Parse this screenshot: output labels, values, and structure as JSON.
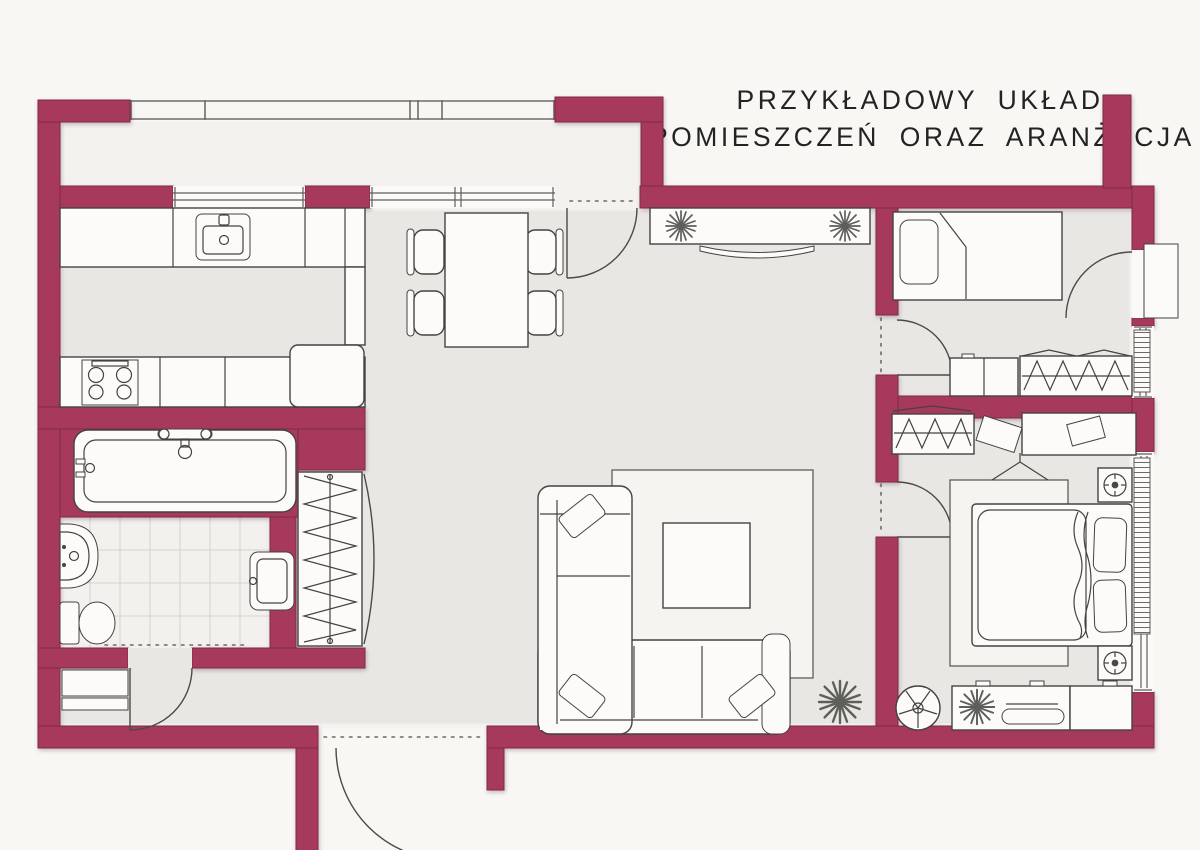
{
  "title": {
    "line_1": "PRZYKŁADOWY UKŁAD",
    "line_2": "POMIESZCZEŃ ORAZ ARANŻACJA"
  },
  "palette": {
    "wall": "#a73a5c",
    "wall_edge": "#7d2a49",
    "floor": "#e9e7e4",
    "tile": "#f2f1ee",
    "outside": "#f8f7f4",
    "furn_fill": "#fcfbf9",
    "furn_stroke": "#45433f",
    "rug": "#f5f4f1",
    "plant": "#5e5e5a",
    "text": "#232323",
    "railing": "#6f6d69"
  },
  "floorplan": {
    "rooms": [
      {
        "name": "balcony",
        "furniture": [
          "railing",
          "partition-wall",
          "pier"
        ]
      },
      {
        "name": "kitchen",
        "furniture": [
          "counter-top",
          "sink",
          "tall-cabinet",
          "counter-bottom",
          "hob",
          "fridge",
          "window"
        ]
      },
      {
        "name": "dining-area",
        "furniture": [
          "table",
          "chair",
          "chair",
          "chair",
          "chair",
          "window",
          "balcony-door"
        ]
      },
      {
        "name": "living-room",
        "furniture": [
          "sideboard",
          "plant",
          "plant",
          "tv-console",
          "rug",
          "coffee-table",
          "corner-sofa",
          "cushions",
          "floor-plant"
        ]
      },
      {
        "name": "hall",
        "furniture": [
          "built-in-wardrobe",
          "bench",
          "entrance-door"
        ]
      },
      {
        "name": "bathroom",
        "furniture": [
          "bathtub",
          "faucet",
          "washbasin",
          "toilet",
          "washer-basin",
          "tiled-floor",
          "door"
        ]
      },
      {
        "name": "bedroom-small",
        "furniture": [
          "single-bed",
          "pillow",
          "dresser",
          "wardrobe",
          "radiator",
          "exterior-door",
          "door"
        ]
      },
      {
        "name": "bedroom-master",
        "furniture": [
          "wardrobe",
          "side-table",
          "desk",
          "laptop",
          "desk-chair",
          "nightstand-lamp",
          "nightstand-lamp",
          "double-bed",
          "pillows",
          "rug",
          "dresser",
          "tv",
          "plant",
          "round-chair",
          "radiator",
          "window",
          "door"
        ]
      }
    ]
  }
}
